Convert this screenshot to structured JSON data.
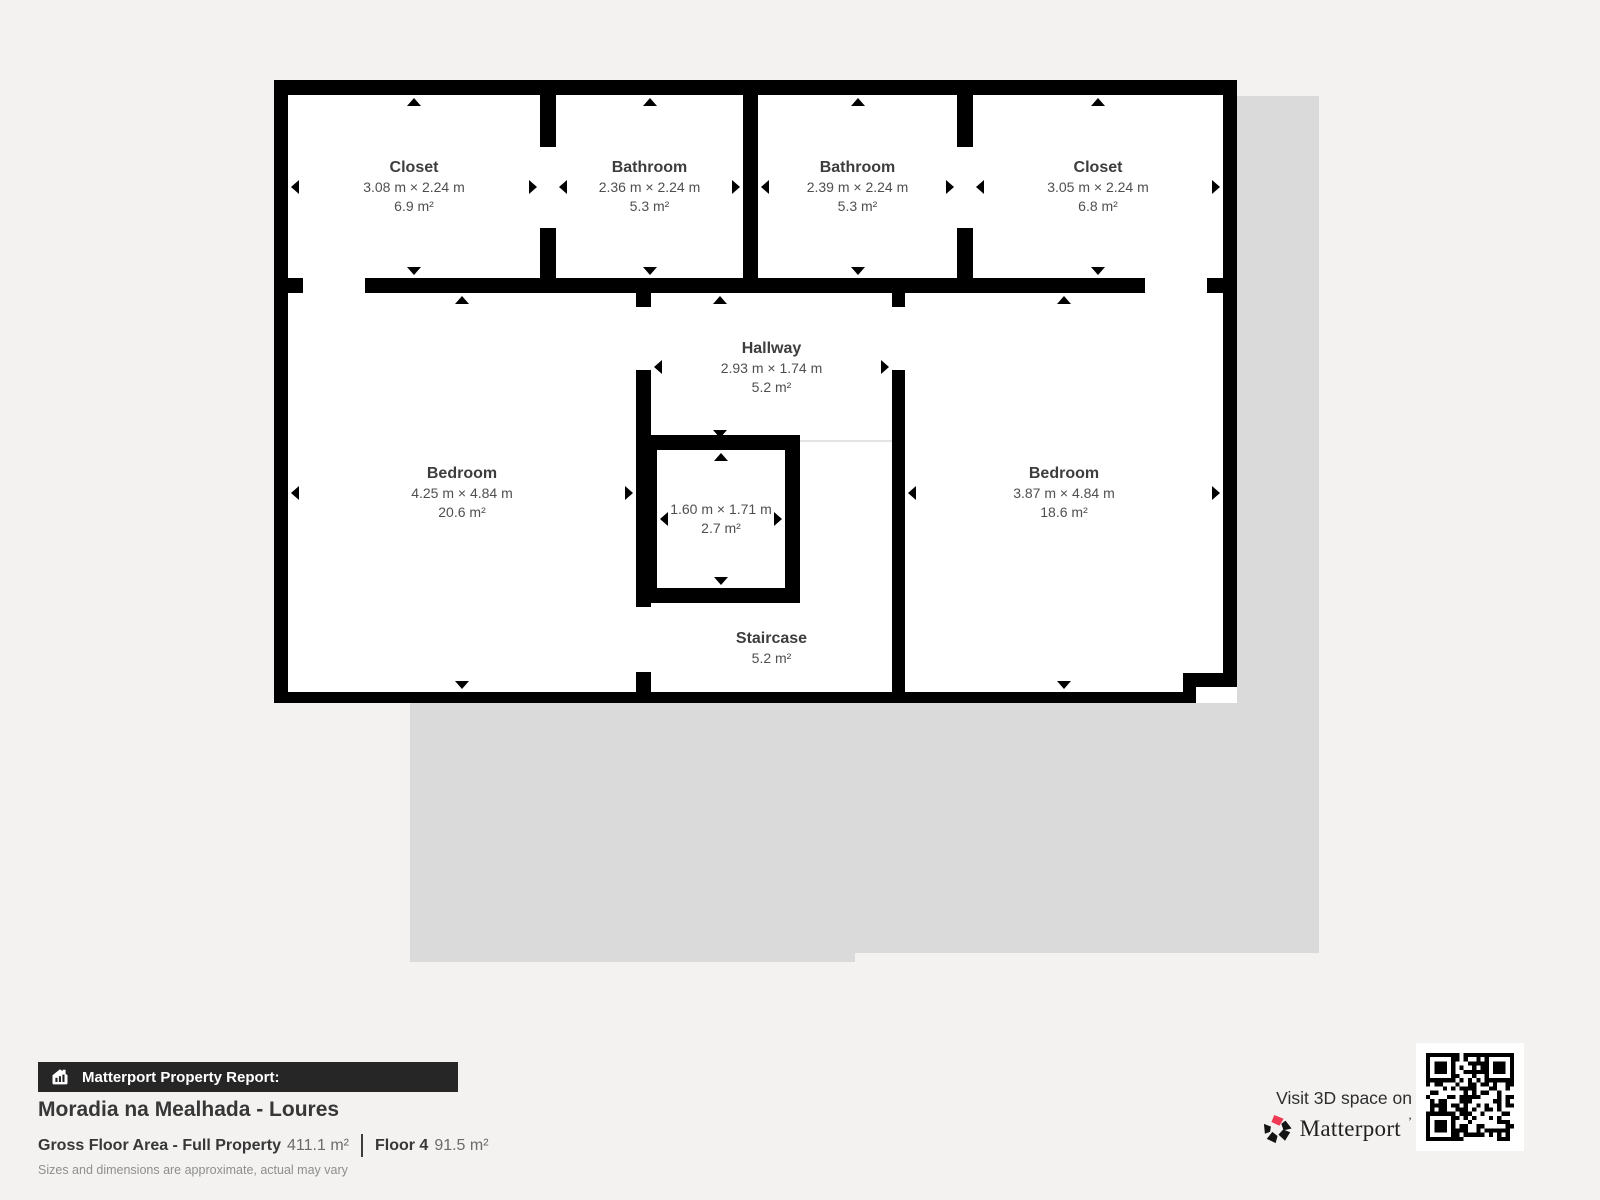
{
  "plan": {
    "rooms": {
      "closet_left": {
        "name": "Closet",
        "dims": "3.08 m × 2.24 m",
        "area": "6.9 m²"
      },
      "bathroom_left": {
        "name": "Bathroom",
        "dims": "2.36 m × 2.24 m",
        "area": "5.3 m²"
      },
      "bathroom_right": {
        "name": "Bathroom",
        "dims": "2.39 m × 2.24 m",
        "area": "5.3 m²"
      },
      "closet_right": {
        "name": "Closet",
        "dims": "3.05 m × 2.24 m",
        "area": "6.8 m²"
      },
      "bedroom_left": {
        "name": "Bedroom",
        "dims": "4.25 m × 4.84 m",
        "area": "20.6 m²"
      },
      "hallway": {
        "name": "Hallway",
        "dims": "2.93 m × 1.74 m",
        "area": "5.2 m²"
      },
      "closet_small": {
        "dims": "1.60 m × 1.71 m",
        "area": "2.7 m²"
      },
      "bedroom_right": {
        "name": "Bedroom",
        "dims": "3.87 m × 4.84 m",
        "area": "18.6 m²"
      },
      "staircase": {
        "name": "Staircase",
        "area": "5.2 m²"
      }
    }
  },
  "report": {
    "badge": "Matterport Property Report:",
    "property_name": "Moradia na Mealhada - Loures",
    "gross_floor_label": "Gross Floor Area - Full Property",
    "gross_floor_value": "411.1 m²",
    "floor_label": "Floor 4",
    "floor_value": "91.5 m²",
    "disclaimer": "Sizes and dimensions are approximate, actual may vary"
  },
  "cta": {
    "visit_text": "Visit 3D space on",
    "brand_name": "Matterport",
    "brand_mark": "’"
  },
  "colors": {
    "background": "#f3f2f1",
    "lower_floor_silhouette": "#dadada",
    "walls": "#000000",
    "brand_accent": "#ef3a55",
    "badge_background": "#262626"
  }
}
